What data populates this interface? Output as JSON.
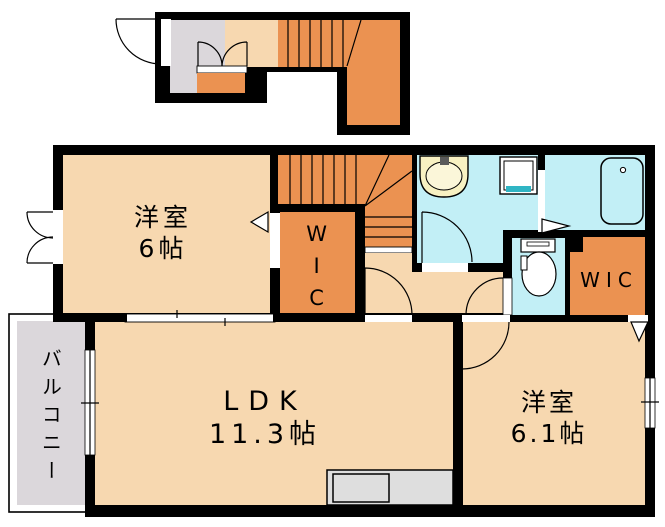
{
  "colors": {
    "wall": "#000000",
    "room": "#F7D8B0",
    "accent": "#EB9251",
    "water": "#C2EFF6",
    "gray": "#DBD7DB",
    "counter": "#DEDEDE",
    "basin": "#F8F1C2",
    "basin-bowl": "#FBF6D9",
    "drain": "#2FB5C4",
    "white": "#FFFFFF"
  },
  "rooms": {
    "bedroom1": {
      "name": "洋室",
      "size": "6帖"
    },
    "wic1": {
      "label": "WIC"
    },
    "ldk": {
      "name": "LDK",
      "size": "11.3帖"
    },
    "bedroom2": {
      "name": "洋室",
      "size": "6.1帖"
    },
    "wic2": {
      "label": "WIC"
    },
    "balcony": {
      "label": "バルコニー"
    }
  }
}
